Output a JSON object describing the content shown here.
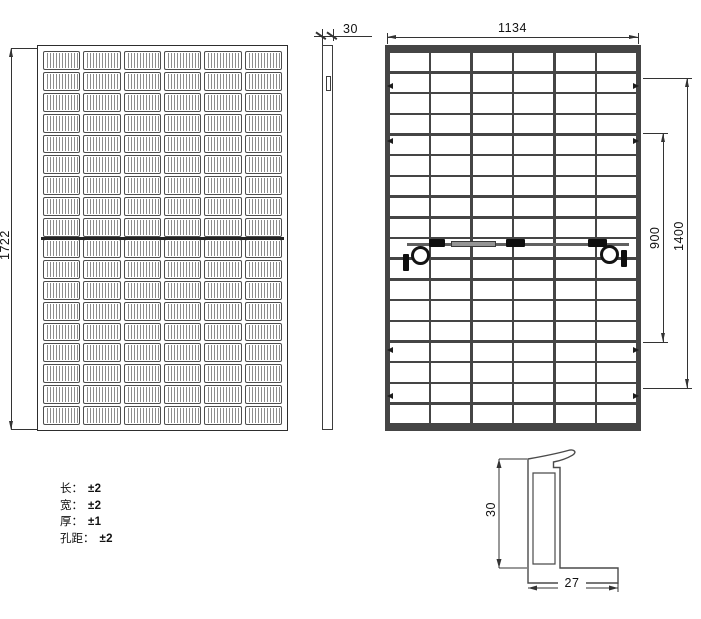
{
  "front_view": {
    "columns": 6,
    "rows": 18,
    "height_dim": "1722"
  },
  "side_view": {
    "thickness_dim": "30"
  },
  "back_view": {
    "columns": 6,
    "rows": 18,
    "width_dim": "1134",
    "mount_hole_dim_inner": "900",
    "mount_hole_dim_outer": "1400"
  },
  "frame_profile": {
    "height_dim": "30",
    "width_dim": "27"
  },
  "tolerances": {
    "rows": [
      {
        "label": "长：",
        "value": "±2"
      },
      {
        "label": "宽：",
        "value": "±2"
      },
      {
        "label": "厚：",
        "value": "±1"
      },
      {
        "label": "孔距：",
        "value": "±2"
      }
    ]
  },
  "colors": {
    "line": "#333333",
    "frame_dark": "#454545",
    "connector_black": "#0f0f0f",
    "cable_gray": "#606060",
    "junction_gray": "#949494"
  }
}
